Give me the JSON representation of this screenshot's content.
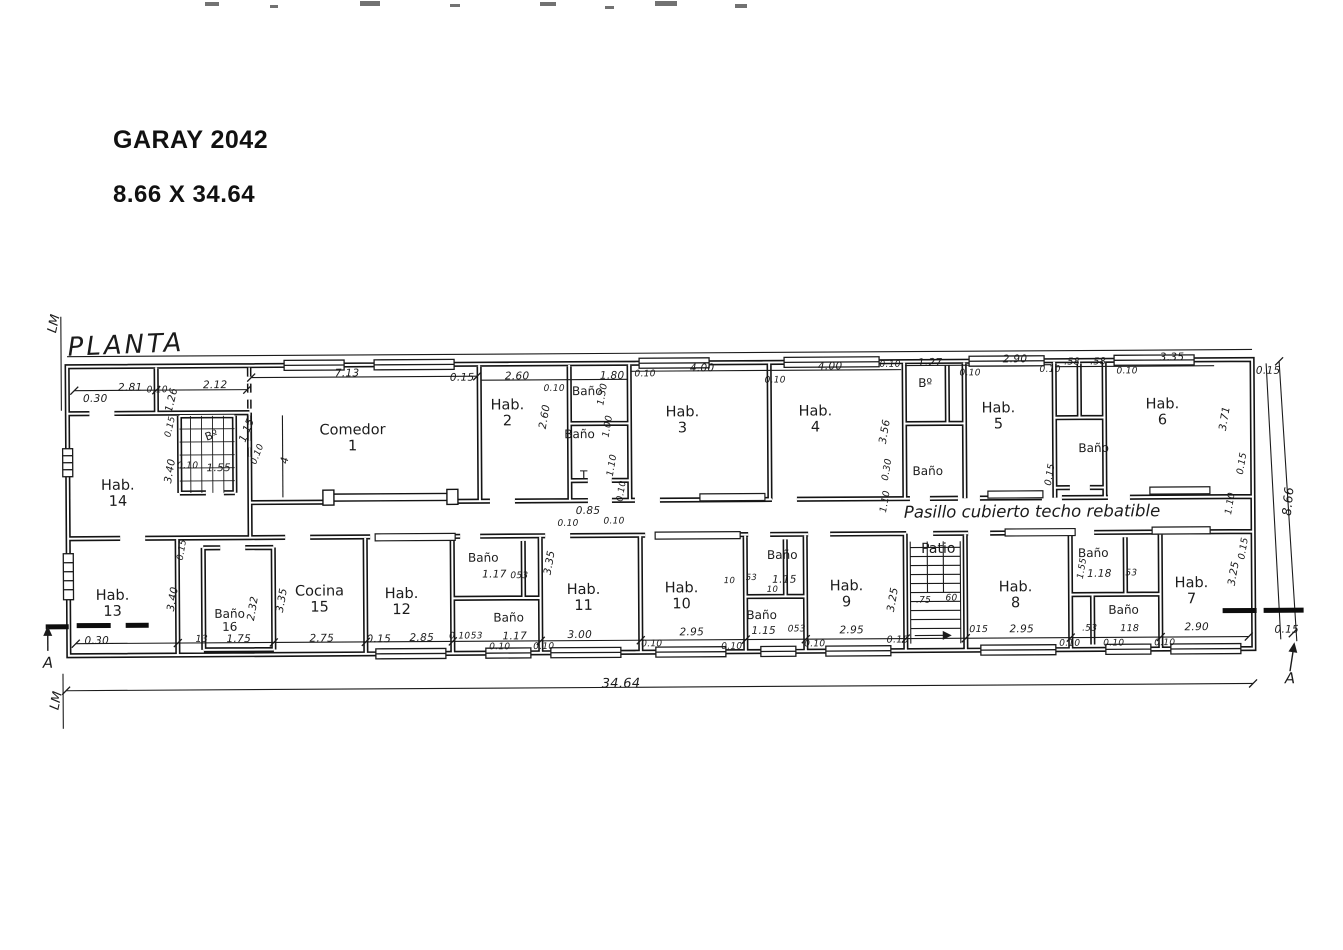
{
  "header": {
    "title": "GARAY 2042",
    "subtitle": "8.66 X 34.64"
  },
  "plan": {
    "labels": [
      {
        "t": "PLANTA",
        "x": 97,
        "y": 47,
        "k": "ptitle",
        "r": -2
      },
      {
        "t": "LM",
        "x": 26,
        "y": 25,
        "k": "anno",
        "r": -78,
        "s": 13
      },
      {
        "t": "LM",
        "x": 26,
        "y": 402,
        "k": "anno",
        "r": -78,
        "s": 13
      },
      {
        "t": "A",
        "x": 17,
        "y": 364,
        "k": "anno",
        "s": 15
      },
      {
        "t": "A",
        "x": 1259,
        "y": 387,
        "k": "anno",
        "s": 15
      },
      {
        "t": "Pasillo cubierto techo rebatible",
        "x": 1002,
        "y": 219,
        "k": "anno",
        "s": 16.5
      },
      {
        "t": "34.64",
        "x": 590,
        "y": 389,
        "k": "dim",
        "s": 13
      },
      {
        "t": "8.66",
        "x": 1258,
        "y": 210,
        "k": "dim",
        "r": -84,
        "s": 12.5
      },
      {
        "t": "Hab.\n14",
        "x": 88,
        "y": 196,
        "k": "room"
      },
      {
        "t": "Bº",
        "x": 182,
        "y": 138,
        "k": "rsm",
        "r": -20,
        "s": 11
      },
      {
        "t": "Comedor\n1",
        "x": 323,
        "y": 142,
        "k": "room"
      },
      {
        "t": "Hab.\n2",
        "x": 478,
        "y": 118,
        "k": "room"
      },
      {
        "t": "Baño",
        "x": 558,
        "y": 96,
        "k": "rsm"
      },
      {
        "t": "Baño",
        "x": 550,
        "y": 139,
        "k": "rsm"
      },
      {
        "t": "T",
        "x": 554,
        "y": 180,
        "k": "rsm"
      },
      {
        "t": "Hab.\n3",
        "x": 653,
        "y": 126,
        "k": "room"
      },
      {
        "t": "Hab.\n4",
        "x": 786,
        "y": 126,
        "k": "room"
      },
      {
        "t": "Bº",
        "x": 896,
        "y": 90,
        "k": "rsm"
      },
      {
        "t": "Baño",
        "x": 898,
        "y": 178,
        "k": "rsm"
      },
      {
        "t": "Hab.\n5",
        "x": 969,
        "y": 124,
        "k": "room"
      },
      {
        "t": "Baño",
        "x": 1064,
        "y": 156,
        "k": "rsm"
      },
      {
        "t": "Hab.\n6",
        "x": 1133,
        "y": 121,
        "k": "room"
      },
      {
        "t": "Hab.\n13",
        "x": 82,
        "y": 306,
        "k": "room"
      },
      {
        "t": "Baño\n16",
        "x": 199,
        "y": 323,
        "k": "rsm"
      },
      {
        "t": "Cocina\n15",
        "x": 289,
        "y": 303,
        "k": "room"
      },
      {
        "t": "Hab.\n12",
        "x": 371,
        "y": 306,
        "k": "room"
      },
      {
        "t": "Baño",
        "x": 453,
        "y": 262,
        "k": "rsm"
      },
      {
        "t": "Baño",
        "x": 478,
        "y": 322,
        "k": "rsm"
      },
      {
        "t": "Hab.\n11",
        "x": 553,
        "y": 303,
        "k": "room"
      },
      {
        "t": "Hab.\n10",
        "x": 651,
        "y": 302,
        "k": "room"
      },
      {
        "t": "Baño",
        "x": 752,
        "y": 261,
        "k": "rsm"
      },
      {
        "t": "Baño",
        "x": 731,
        "y": 321,
        "k": "rsm"
      },
      {
        "t": "Hab.\n9",
        "x": 816,
        "y": 301,
        "k": "room"
      },
      {
        "t": "Patio",
        "x": 908,
        "y": 256,
        "k": "rsm",
        "s": 14
      },
      {
        "t": "Hab.\n8",
        "x": 985,
        "y": 303,
        "k": "room"
      },
      {
        "t": "Baño",
        "x": 1063,
        "y": 261,
        "k": "rsm"
      },
      {
        "t": "Baño",
        "x": 1093,
        "y": 318,
        "k": "rsm"
      },
      {
        "t": "Hab.\n7",
        "x": 1161,
        "y": 300,
        "k": "room"
      },
      {
        "t": "0.30",
        "x": 66,
        "y": 101,
        "k": "dim"
      },
      {
        "t": "2.81",
        "x": 101,
        "y": 90,
        "k": "dim"
      },
      {
        "t": "0.10",
        "x": 128,
        "y": 93,
        "k": "dim",
        "s": 9
      },
      {
        "t": "2.12",
        "x": 186,
        "y": 88,
        "k": "dim"
      },
      {
        "t": "7.13",
        "x": 318,
        "y": 77,
        "k": "dim"
      },
      {
        "t": "0.15",
        "x": 433,
        "y": 82,
        "k": "dim"
      },
      {
        "t": "2.60",
        "x": 488,
        "y": 81,
        "k": "dim"
      },
      {
        "t": "0.10",
        "x": 525,
        "y": 94,
        "k": "dim",
        "s": 9
      },
      {
        "t": "1.80",
        "x": 583,
        "y": 81,
        "k": "dim"
      },
      {
        "t": "0.10",
        "x": 616,
        "y": 80,
        "k": "dim",
        "s": 9
      },
      {
        "t": "4.00",
        "x": 673,
        "y": 74,
        "k": "dim"
      },
      {
        "t": "0.10",
        "x": 746,
        "y": 87,
        "k": "dim",
        "s": 9
      },
      {
        "t": "4.00",
        "x": 801,
        "y": 73,
        "k": "dim"
      },
      {
        "t": "0.10",
        "x": 861,
        "y": 72,
        "k": "dim",
        "s": 9
      },
      {
        "t": "1.27",
        "x": 901,
        "y": 70,
        "k": "dim"
      },
      {
        "t": "0.10",
        "x": 941,
        "y": 81,
        "k": "dim",
        "s": 9
      },
      {
        "t": "2.90",
        "x": 986,
        "y": 67,
        "k": "dim"
      },
      {
        "t": "0.10",
        "x": 1021,
        "y": 78,
        "k": "dim",
        "s": 9
      },
      {
        "t": ".58",
        "x": 1043,
        "y": 70,
        "k": "dim",
        "s": 9.5
      },
      {
        "t": ".58",
        "x": 1069,
        "y": 70,
        "k": "dim",
        "s": 9.5
      },
      {
        "t": "0.10",
        "x": 1098,
        "y": 80,
        "k": "dim",
        "s": 9
      },
      {
        "t": "3.35",
        "x": 1143,
        "y": 66,
        "k": "dim"
      },
      {
        "t": "0.15",
        "x": 1239,
        "y": 80,
        "k": "dim"
      },
      {
        "t": "1.26",
        "x": 143,
        "y": 102,
        "k": "dim",
        "r": -76
      },
      {
        "t": "0.15",
        "x": 142,
        "y": 129,
        "k": "dim",
        "r": -76,
        "s": 9
      },
      {
        "t": "3.40",
        "x": 141,
        "y": 173,
        "k": "dim",
        "r": -80
      },
      {
        "t": "0.10",
        "x": 158,
        "y": 169,
        "k": "dim",
        "s": 9
      },
      {
        "t": "1.55",
        "x": 189,
        "y": 171,
        "k": "dim"
      },
      {
        "t": "1.15",
        "x": 218,
        "y": 133,
        "k": "dim",
        "r": -68
      },
      {
        "t": "0.10",
        "x": 229,
        "y": 157,
        "k": "dim",
        "r": -68,
        "s": 9
      },
      {
        "t": "4",
        "x": 256,
        "y": 163,
        "k": "dim",
        "r": -80
      },
      {
        "t": "2.60",
        "x": 516,
        "y": 121,
        "k": "dim",
        "r": -80
      },
      {
        "t": "1.30",
        "x": 574,
        "y": 99,
        "k": "dim",
        "r": -80,
        "s": 9.5
      },
      {
        "t": "1.00",
        "x": 579,
        "y": 131,
        "k": "dim",
        "r": -80,
        "s": 9.5
      },
      {
        "t": "1.10",
        "x": 583,
        "y": 170,
        "k": "dim",
        "r": -80,
        "s": 9.5
      },
      {
        "t": "0.10",
        "x": 593,
        "y": 196,
        "k": "dim",
        "r": -80,
        "s": 9
      },
      {
        "t": "0.10",
        "x": 538,
        "y": 229,
        "k": "dim",
        "s": 9
      },
      {
        "t": "0.85",
        "x": 558,
        "y": 216,
        "k": "dim"
      },
      {
        "t": "0.10",
        "x": 584,
        "y": 227,
        "k": "dim",
        "s": 9
      },
      {
        "t": "3.56",
        "x": 856,
        "y": 138,
        "k": "dim",
        "r": -80
      },
      {
        "t": "0.30",
        "x": 858,
        "y": 176,
        "k": "dim",
        "r": -80,
        "s": 9.5
      },
      {
        "t": "1.10",
        "x": 856,
        "y": 208,
        "k": "dim",
        "r": -80,
        "s": 9.5
      },
      {
        "t": "0.15",
        "x": 1021,
        "y": 182,
        "k": "dim",
        "r": -80,
        "s": 9.5
      },
      {
        "t": "3.71",
        "x": 1196,
        "y": 127,
        "k": "dim",
        "r": -80
      },
      {
        "t": "0.15",
        "x": 1213,
        "y": 172,
        "k": "dim",
        "r": -80,
        "s": 9.5
      },
      {
        "t": "1.10",
        "x": 1201,
        "y": 212,
        "k": "dim",
        "r": -80,
        "s": 9.5
      },
      {
        "t": "0.15",
        "x": 1214,
        "y": 257,
        "k": "dim",
        "r": -80,
        "s": 9.5
      },
      {
        "t": "3.25",
        "x": 1204,
        "y": 282,
        "k": "dim",
        "r": -80
      },
      {
        "t": "0.15",
        "x": 1256,
        "y": 339,
        "k": "dim"
      },
      {
        "t": "0.30",
        "x": 66,
        "y": 343,
        "k": "dim"
      },
      {
        "t": "13",
        "x": 171,
        "y": 342,
        "k": "dim",
        "s": 9.5
      },
      {
        "t": "3.40",
        "x": 143,
        "y": 301,
        "k": "dim",
        "r": -80
      },
      {
        "t": "0.15",
        "x": 153,
        "y": 252,
        "k": "dim",
        "r": -80,
        "s": 9
      },
      {
        "t": "2.32",
        "x": 223,
        "y": 311,
        "k": "dim",
        "r": -80
      },
      {
        "t": "1.75",
        "x": 208,
        "y": 342,
        "k": "dim"
      },
      {
        "t": "3.35",
        "x": 252,
        "y": 303,
        "k": "dim",
        "r": -80
      },
      {
        "t": "2.75",
        "x": 291,
        "y": 342,
        "k": "dim"
      },
      {
        "t": "0.15",
        "x": 348,
        "y": 343,
        "k": "dim"
      },
      {
        "t": "2.85",
        "x": 391,
        "y": 342,
        "k": "dim"
      },
      {
        "t": "0.10",
        "x": 429,
        "y": 341,
        "k": "dim",
        "s": 9
      },
      {
        "t": "53",
        "x": 446,
        "y": 341,
        "k": "dim",
        "s": 9
      },
      {
        "t": "1.17",
        "x": 464,
        "y": 279,
        "k": "dim"
      },
      {
        "t": "053",
        "x": 489,
        "y": 281,
        "k": "dim",
        "s": 9
      },
      {
        "t": "1.17",
        "x": 484,
        "y": 341,
        "k": "dim"
      },
      {
        "t": "0.10",
        "x": 469,
        "y": 352,
        "k": "dim",
        "s": 9
      },
      {
        "t": "0.10",
        "x": 513,
        "y": 352,
        "k": "dim",
        "s": 9
      },
      {
        "t": "3.35",
        "x": 520,
        "y": 267,
        "k": "dim",
        "r": -80
      },
      {
        "t": "3.00",
        "x": 549,
        "y": 340,
        "k": "dim"
      },
      {
        "t": "2.95",
        "x": 661,
        "y": 338,
        "k": "dim"
      },
      {
        "t": "0.10",
        "x": 621,
        "y": 350,
        "k": "dim",
        "s": 9
      },
      {
        "t": "0.10",
        "x": 701,
        "y": 353,
        "k": "dim",
        "s": 9
      },
      {
        "t": "10",
        "x": 699,
        "y": 287,
        "k": "dim",
        "s": 8.5
      },
      {
        "t": "53",
        "x": 721,
        "y": 284,
        "k": "dim",
        "s": 8.5
      },
      {
        "t": "1.15",
        "x": 754,
        "y": 286,
        "k": "dim"
      },
      {
        "t": "10",
        "x": 742,
        "y": 296,
        "k": "dim",
        "s": 8.5
      },
      {
        "t": "1.15",
        "x": 733,
        "y": 337,
        "k": "dim"
      },
      {
        "t": "053",
        "x": 766,
        "y": 336,
        "k": "dim",
        "s": 9
      },
      {
        "t": "0.10",
        "x": 784,
        "y": 351,
        "k": "dim",
        "s": 9
      },
      {
        "t": "2.95",
        "x": 821,
        "y": 337,
        "k": "dim"
      },
      {
        "t": "3.25",
        "x": 863,
        "y": 306,
        "k": "dim",
        "r": -80
      },
      {
        "t": ".75",
        "x": 893,
        "y": 308,
        "k": "dim",
        "s": 9
      },
      {
        "t": "60",
        "x": 921,
        "y": 306,
        "k": "dim",
        "s": 9
      },
      {
        "t": "0.15",
        "x": 867,
        "y": 347,
        "k": "dim",
        "s": 9.5
      },
      {
        "t": "015",
        "x": 948,
        "y": 337,
        "k": "dim",
        "s": 9.5
      },
      {
        "t": "2.95",
        "x": 991,
        "y": 337,
        "k": "dim"
      },
      {
        "t": "0.10",
        "x": 1039,
        "y": 352,
        "k": "dim",
        "s": 9
      },
      {
        "t": ".53",
        "x": 1059,
        "y": 337,
        "k": "dim",
        "s": 9
      },
      {
        "t": "1.55",
        "x": 1053,
        "y": 276,
        "k": "dim",
        "r": -80,
        "s": 9
      },
      {
        "t": "1.18",
        "x": 1069,
        "y": 282,
        "k": "dim"
      },
      {
        "t": "53",
        "x": 1101,
        "y": 282,
        "k": "dim",
        "s": 9
      },
      {
        "t": "118",
        "x": 1099,
        "y": 337,
        "k": "dim",
        "s": 9.5
      },
      {
        "t": "0.10",
        "x": 1083,
        "y": 352,
        "k": "dim",
        "s": 9
      },
      {
        "t": "0.10",
        "x": 1134,
        "y": 352,
        "k": "dim",
        "s": 9
      },
      {
        "t": "2.90",
        "x": 1166,
        "y": 336,
        "k": "dim"
      }
    ]
  }
}
